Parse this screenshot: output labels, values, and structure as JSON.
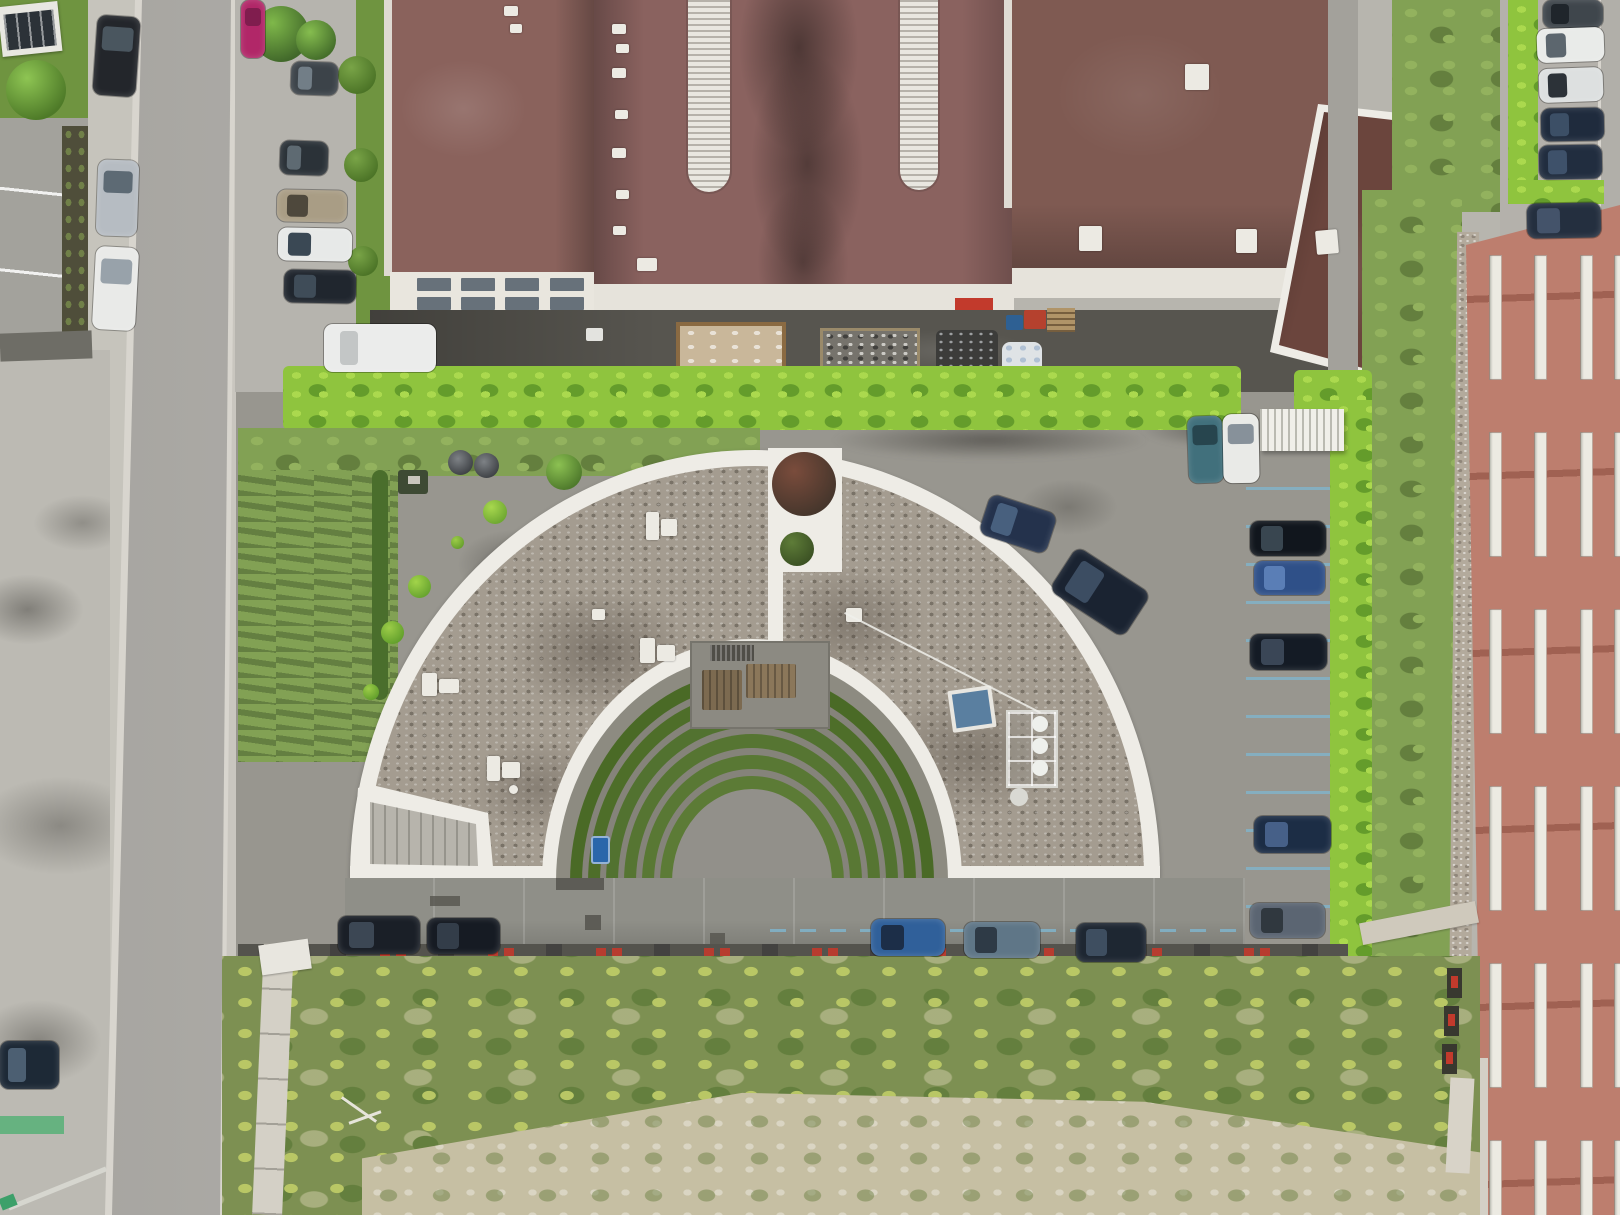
{
  "scene": {
    "type": "aerial-drone-photograph",
    "subject": "top-down view of a white semicircular building with gravel roof and concentric green amphitheatre courtyard, surrounded by parking, hedges, an industrial hall with brown roof (top), a salmon-red apartment block (right), streets (left) and a wild grass field (bottom)"
  },
  "palette": {
    "base": "#b7b5ae",
    "street": "#b3b1ac",
    "street_edge": "#d8d5ce",
    "sidewalk": "#c9c6bf",
    "apron": "#bcbab3",
    "lot": "#a3a29c",
    "site": "#98968f",
    "site_dark": "#7b7a74",
    "hedge": "#8fc43e",
    "hedge_light": "#abd94e",
    "hedge_dark": "#649c2b",
    "lawn": "#82a154",
    "lawn_light": "#93b25e",
    "lawn_dark": "#647f3e",
    "wild": "#7d9052",
    "wild_yellow": "#b9c765",
    "sand": "#c6bfa3",
    "roof_main": "#8a625f",
    "roof_west": "#8a625c",
    "roof_right": "#7f5a52",
    "roof_annex": "#6b453d",
    "skylight": "#e9e7e0",
    "parapet": "#e6e3db",
    "facade": "#e9e6de",
    "window": "#67717a",
    "ground_dark": "#57554f",
    "rim": "#eeece6",
    "gravel": "#a49c90",
    "walkway": "#8f8f88",
    "plaza": "#92908a",
    "red_facade": "#bd7e6e",
    "red_window": "#eceae2",
    "blue_line": "#7fb6cf",
    "red_mark": "#c23a2c",
    "path_light": "#d4d0c6",
    "moss_wall": "#4f4e3a"
  },
  "objects": {
    "cars": [
      {
        "x": 95,
        "y": 16,
        "w": 43,
        "h": 80,
        "rot": 4,
        "o": "v",
        "body": "#23262b",
        "glass": "#4a565f"
      },
      {
        "x": 97,
        "y": 160,
        "w": 41,
        "h": 76,
        "rot": 2,
        "o": "v",
        "body": "#b6bcc2",
        "glass": "#5d6a74"
      },
      {
        "x": 94,
        "y": 247,
        "w": 43,
        "h": 83,
        "rot": 3,
        "o": "v",
        "body": "#e9eae8",
        "glass": "#98a2aa"
      },
      {
        "x": 0,
        "y": 1041,
        "w": 59,
        "h": 48,
        "rot": 0,
        "o": "h",
        "body": "#1d2936",
        "glass": "#4c5f72"
      },
      {
        "x": 241,
        "y": 0,
        "w": 24,
        "h": 58,
        "rot": 0,
        "o": "v",
        "body": "#b12768",
        "glass": "#801d4e"
      },
      {
        "x": 291,
        "y": 62,
        "w": 47,
        "h": 33,
        "rot": 2,
        "o": "h",
        "body": "#3c4349",
        "glass": "#727e87"
      },
      {
        "x": 280,
        "y": 141,
        "w": 48,
        "h": 34,
        "rot": 2,
        "o": "h",
        "body": "#2b3238",
        "glass": "#5e6a72"
      },
      {
        "x": 277,
        "y": 190,
        "w": 70,
        "h": 32,
        "rot": 1,
        "o": "h",
        "body": "#a99d85",
        "glass": "#4e483c"
      },
      {
        "x": 278,
        "y": 228,
        "w": 74,
        "h": 33,
        "rot": 1,
        "o": "h",
        "body": "#e7e9e8",
        "glass": "#3a4854"
      },
      {
        "x": 284,
        "y": 270,
        "w": 72,
        "h": 33,
        "rot": 1,
        "o": "h",
        "body": "#20262e",
        "glass": "#3f4c58"
      },
      {
        "x": 1543,
        "y": 0,
        "w": 60,
        "h": 28,
        "rot": 0,
        "o": "h",
        "body": "#3f464c",
        "glass": "#1f252b"
      },
      {
        "x": 1537,
        "y": 28,
        "w": 67,
        "h": 34,
        "rot": -2,
        "o": "h",
        "body": "#e9ebe9",
        "glass": "#5c666e"
      },
      {
        "x": 1539,
        "y": 68,
        "w": 64,
        "h": 34,
        "rot": -2,
        "o": "h",
        "body": "#dde0e0",
        "glass": "#2c3238"
      },
      {
        "x": 1541,
        "y": 108,
        "w": 63,
        "h": 33,
        "rot": -1,
        "o": "h",
        "body": "#1f2b3d",
        "glass": "#3c4f66"
      },
      {
        "x": 1539,
        "y": 145,
        "w": 63,
        "h": 34,
        "rot": -1,
        "o": "h",
        "body": "#212d3f",
        "glass": "#3e516a"
      },
      {
        "x": 1527,
        "y": 203,
        "w": 74,
        "h": 35,
        "rot": -1,
        "o": "h",
        "body": "#242f3f",
        "glass": "#44536a"
      },
      {
        "x": 1188,
        "y": 416,
        "w": 35,
        "h": 67,
        "rot": -2,
        "o": "v",
        "body": "#41707c",
        "glass": "#27454e"
      },
      {
        "x": 1223,
        "y": 414,
        "w": 36,
        "h": 69,
        "rot": -1,
        "o": "v",
        "body": "#e9eae7",
        "glass": "#87919a"
      },
      {
        "x": 983,
        "y": 503,
        "w": 70,
        "h": 42,
        "rot": 18,
        "o": "h",
        "body": "#24324c",
        "glass": "#48607e"
      },
      {
        "x": 1056,
        "y": 566,
        "w": 88,
        "h": 52,
        "rot": 33,
        "o": "h",
        "body": "#1a2331",
        "glass": "#3c4d62"
      },
      {
        "x": 1250,
        "y": 521,
        "w": 76,
        "h": 35,
        "rot": 0,
        "o": "h",
        "body": "#11161d",
        "glass": "#394650"
      },
      {
        "x": 1254,
        "y": 561,
        "w": 71,
        "h": 34,
        "rot": 0,
        "o": "h",
        "body": "#2f5088",
        "glass": "#5a7eb6"
      },
      {
        "x": 1250,
        "y": 634,
        "w": 77,
        "h": 36,
        "rot": 0,
        "o": "h",
        "body": "#141b25",
        "glass": "#3a4656"
      },
      {
        "x": 1254,
        "y": 816,
        "w": 77,
        "h": 37,
        "rot": 0,
        "o": "h",
        "body": "#1c2d45",
        "glass": "#466088"
      },
      {
        "x": 1250,
        "y": 903,
        "w": 75,
        "h": 35,
        "rot": 0,
        "o": "h",
        "body": "#5b6572",
        "glass": "#30383f"
      },
      {
        "x": 338,
        "y": 916,
        "w": 82,
        "h": 38,
        "rot": 0,
        "o": "h",
        "body": "#1a1f27",
        "glass": "#3c4754"
      },
      {
        "x": 427,
        "y": 918,
        "w": 73,
        "h": 36,
        "rot": 0,
        "o": "h",
        "body": "#161b23",
        "glass": "#333d49"
      },
      {
        "x": 871,
        "y": 919,
        "w": 74,
        "h": 37,
        "rot": 0,
        "o": "h",
        "body": "#30609a",
        "glass": "#1c2e48"
      },
      {
        "x": 964,
        "y": 922,
        "w": 76,
        "h": 36,
        "rot": 0,
        "o": "h",
        "body": "#5f7687",
        "glass": "#2e3a46"
      },
      {
        "x": 1076,
        "y": 923,
        "w": 70,
        "h": 39,
        "rot": 0,
        "o": "h",
        "body": "#1e2732",
        "glass": "#3e4e60"
      },
      {
        "x": 324,
        "y": 324,
        "w": 112,
        "h": 48,
        "rot": 0,
        "o": "h",
        "body": "#ebeceb",
        "glass": "#c3c6c6",
        "truck": true
      }
    ],
    "trees": [
      {
        "x": 6,
        "y": 60,
        "d": 60,
        "c1": "#8ec553",
        "c2": "#4e7a28"
      },
      {
        "x": 253,
        "y": 6,
        "d": 56,
        "c1": "#7fb84a",
        "c2": "#41682a"
      },
      {
        "x": 296,
        "y": 20,
        "d": 40,
        "c1": "#86bd4f",
        "c2": "#456f2b"
      },
      {
        "x": 338,
        "y": 56,
        "d": 38,
        "c1": "#79a447",
        "c2": "#4c7427"
      },
      {
        "x": 344,
        "y": 148,
        "d": 34,
        "c1": "#79a447",
        "c2": "#4c7427"
      },
      {
        "x": 348,
        "y": 246,
        "d": 30,
        "c1": "#79a447",
        "c2": "#4c7427"
      },
      {
        "x": 546,
        "y": 454,
        "d": 36,
        "c1": "#8cc152",
        "c2": "#4f7a2c"
      },
      {
        "x": 483,
        "y": 500,
        "d": 24,
        "c1": "#a8d84e",
        "c2": "#6fa832"
      },
      {
        "x": 451,
        "y": 536,
        "d": 13,
        "c1": "#9ccc48",
        "c2": "#68a02e"
      },
      {
        "x": 408,
        "y": 575,
        "d": 23,
        "c1": "#a2d44a",
        "c2": "#68a42f"
      },
      {
        "x": 381,
        "y": 621,
        "d": 23,
        "c1": "#9ccc48",
        "c2": "#63a02c"
      },
      {
        "x": 363,
        "y": 684,
        "d": 16,
        "c1": "#9ccc48",
        "c2": "#63a02c"
      },
      {
        "x": 772,
        "y": 452,
        "d": 64,
        "c1": "#7a4c3c",
        "c2": "#46362c"
      },
      {
        "x": 780,
        "y": 532,
        "d": 34,
        "c1": "#5e7c38",
        "c2": "#3c5224"
      }
    ],
    "planters": [
      {
        "x": 448,
        "y": 450,
        "d": 25,
        "c1": "#7e8286",
        "c2": "#3f4246"
      },
      {
        "x": 474,
        "y": 453,
        "d": 25,
        "c1": "#7e8286",
        "c2": "#3f4246"
      }
    ],
    "roof_vents": [
      {
        "x": 612,
        "y": 24,
        "w": 14,
        "h": 10
      },
      {
        "x": 616,
        "y": 44,
        "w": 13,
        "h": 9
      },
      {
        "x": 612,
        "y": 68,
        "w": 14,
        "h": 10
      },
      {
        "x": 615,
        "y": 110,
        "w": 13,
        "h": 9
      },
      {
        "x": 612,
        "y": 148,
        "w": 14,
        "h": 10
      },
      {
        "x": 616,
        "y": 190,
        "w": 13,
        "h": 9
      },
      {
        "x": 613,
        "y": 226,
        "w": 13,
        "h": 9
      },
      {
        "x": 637,
        "y": 258,
        "w": 20,
        "h": 13
      },
      {
        "x": 504,
        "y": 6,
        "w": 14,
        "h": 10
      },
      {
        "x": 510,
        "y": 24,
        "w": 12,
        "h": 9
      },
      {
        "x": 1185,
        "y": 64,
        "w": 24,
        "h": 26
      },
      {
        "x": 1079,
        "y": 226,
        "w": 23,
        "h": 25
      },
      {
        "x": 1236,
        "y": 229,
        "w": 21,
        "h": 24
      },
      {
        "x": 1316,
        "y": 230,
        "w": 22,
        "h": 24,
        "rot": -5
      }
    ],
    "roof_items": [
      {
        "x": 646,
        "y": 512,
        "w": 13,
        "h": 28
      },
      {
        "x": 661,
        "y": 519,
        "w": 16,
        "h": 17
      },
      {
        "x": 592,
        "y": 609,
        "w": 13,
        "h": 11
      },
      {
        "x": 640,
        "y": 638,
        "w": 15,
        "h": 25
      },
      {
        "x": 657,
        "y": 645,
        "w": 18,
        "h": 16
      },
      {
        "x": 422,
        "y": 673,
        "w": 15,
        "h": 23
      },
      {
        "x": 439,
        "y": 679,
        "w": 20,
        "h": 14
      },
      {
        "x": 487,
        "y": 756,
        "w": 13,
        "h": 25
      },
      {
        "x": 502,
        "y": 762,
        "w": 18,
        "h": 16
      },
      {
        "x": 509,
        "y": 785,
        "w": 9,
        "h": 9,
        "br": 50
      },
      {
        "x": 846,
        "y": 608,
        "w": 16,
        "h": 14
      }
    ],
    "facade_windows": {
      "cols": [
        417,
        461,
        505,
        550
      ],
      "rows": [
        278,
        297
      ],
      "w": 34,
      "h": 13
    },
    "red_windows": {
      "cols": [
        1489,
        1534,
        1580,
        1614
      ],
      "w": 13,
      "row_start": 255,
      "row_h": 125,
      "row_gap": 52,
      "count": 6
    },
    "stall_lines": {
      "x": 1246,
      "w": 84,
      "y_start": 487,
      "step": 38,
      "count": 12
    },
    "amphitheater": {
      "cx": 752,
      "chord_y": 882,
      "ry_ratio": 1.157,
      "rings": [
        {
          "rx": 196,
          "c": "#8d8b81"
        },
        {
          "rx": 182,
          "c": "#4a6a26"
        },
        {
          "rx": 170,
          "c": "#85837a"
        },
        {
          "rx": 164,
          "c": "#4e6e29"
        },
        {
          "rx": 152,
          "c": "#85837a"
        },
        {
          "rx": 146,
          "c": "#527230"
        },
        {
          "rx": 134,
          "c": "#85837a"
        },
        {
          "rx": 128,
          "c": "#567532"
        },
        {
          "rx": 116,
          "c": "#85837a"
        },
        {
          "rx": 110,
          "c": "#597834"
        },
        {
          "rx": 98,
          "c": "#85837a"
        },
        {
          "rx": 92,
          "c": "#5c7b36"
        },
        {
          "rx": 80,
          "c": "#92908a"
        }
      ]
    }
  }
}
